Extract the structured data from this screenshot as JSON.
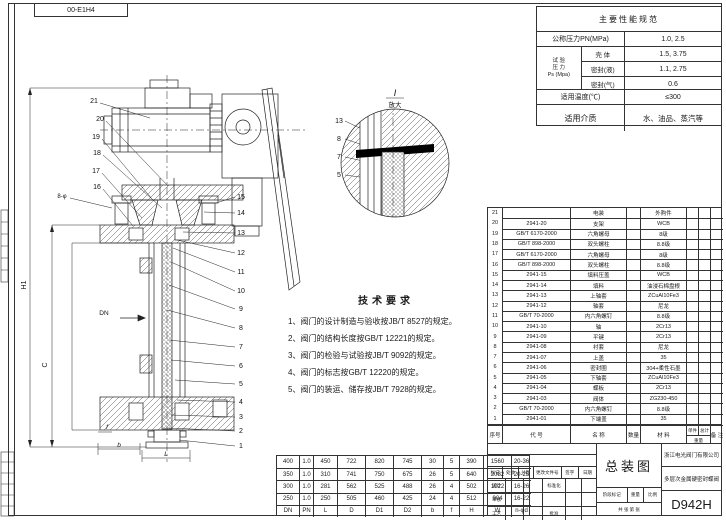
{
  "drawing_code": "00-E1H4",
  "spec_table": {
    "title": "主要性能规范",
    "pn_label": "公称压力PN(MPa)",
    "pn_value": "1.0, 2.5",
    "test_group": [
      "试 验",
      "压 力",
      "Ps (Mpa)"
    ],
    "test_rows": [
      {
        "label": "壳 体",
        "value": "1.5, 3.75"
      },
      {
        "label": "密封(液)",
        "value": "1.1, 2.75"
      },
      {
        "label": "密封(气)",
        "value": "0.6"
      }
    ],
    "temp_label": "适用温度(℃)",
    "temp_value": "≤300",
    "medium_label": "适用介质",
    "medium_value": "水、油品、蒸汽等"
  },
  "tech_requirements": {
    "title": "技术要求",
    "items": [
      "1、阀门的设计制造与验收按JB/T 8527的规定。",
      "2、阀门的结构长度按GB/T 12221的规定。",
      "3、阀门的检验与试验按JB/T 9092的规定。",
      "4、阀门的标志按GB/T 12220的规定。",
      "5、阀门的装运、储存按JB/T 7928的规定。"
    ]
  },
  "parts_table": {
    "headers": {
      "seq": "序号",
      "code": "代  号",
      "name": "名  称",
      "qty": "数量",
      "material": "材  料",
      "unit": "单件",
      "total": "总计",
      "weight": "重量",
      "note": "备 注"
    },
    "rows": [
      {
        "seq": "21",
        "code": "",
        "name": "电装",
        "qty": "",
        "mat": "外购件",
        "unit": "",
        "tot": "",
        "note": ""
      },
      {
        "seq": "20",
        "code": "2941-20",
        "name": "支架",
        "qty": "",
        "mat": "WCB",
        "unit": "",
        "tot": "",
        "note": ""
      },
      {
        "seq": "19",
        "code": "GB/T 6170-2000",
        "name": "六角螺母",
        "qty": "",
        "mat": "8级",
        "unit": "",
        "tot": "",
        "note": ""
      },
      {
        "seq": "18",
        "code": "GB/T 898-2000",
        "name": "双头螺柱",
        "qty": "",
        "mat": "8.8级",
        "unit": "",
        "tot": "",
        "note": ""
      },
      {
        "seq": "17",
        "code": "GB/T 6170-2000",
        "name": "六角螺母",
        "qty": "",
        "mat": "8级",
        "unit": "",
        "tot": "",
        "note": ""
      },
      {
        "seq": "16",
        "code": "GB/T 898-2000",
        "name": "双头螺柱",
        "qty": "",
        "mat": "8.8级",
        "unit": "",
        "tot": "",
        "note": ""
      },
      {
        "seq": "15",
        "code": "2941-15",
        "name": "填料压盖",
        "qty": "",
        "mat": "WCB",
        "unit": "",
        "tot": "",
        "note": ""
      },
      {
        "seq": "14",
        "code": "2941-14",
        "name": "填料",
        "qty": "",
        "mat": "油浸石棉盘根",
        "unit": "",
        "tot": "",
        "note": ""
      },
      {
        "seq": "13",
        "code": "2941-13",
        "name": "上轴套",
        "qty": "",
        "mat": "ZCuAl10Fe3",
        "unit": "",
        "tot": "",
        "note": ""
      },
      {
        "seq": "12",
        "code": "2941-12",
        "name": "轴套",
        "qty": "",
        "mat": "尼龙",
        "unit": "",
        "tot": "",
        "note": ""
      },
      {
        "seq": "11",
        "code": "GB/T 70-2000",
        "name": "内六角螺钉",
        "qty": "",
        "mat": "8.8级",
        "unit": "",
        "tot": "",
        "note": ""
      },
      {
        "seq": "10",
        "code": "2941-10",
        "name": "轴",
        "qty": "",
        "mat": "2Cr13",
        "unit": "",
        "tot": "",
        "note": ""
      },
      {
        "seq": "9",
        "code": "2941-09",
        "name": "平键",
        "qty": "",
        "mat": "2Cr13",
        "unit": "",
        "tot": "",
        "note": ""
      },
      {
        "seq": "8",
        "code": "2941-08",
        "name": "衬套",
        "qty": "",
        "mat": "尼龙",
        "unit": "",
        "tot": "",
        "note": ""
      },
      {
        "seq": "7",
        "code": "2941-07",
        "name": "上盖",
        "qty": "",
        "mat": "35",
        "unit": "",
        "tot": "",
        "note": ""
      },
      {
        "seq": "6",
        "code": "2941-06",
        "name": "密封圈",
        "qty": "",
        "mat": "304+柔性石墨",
        "unit": "",
        "tot": "",
        "note": ""
      },
      {
        "seq": "5",
        "code": "2941-05",
        "name": "下轴套",
        "qty": "",
        "mat": "ZCuAl10Fe3",
        "unit": "",
        "tot": "",
        "note": ""
      },
      {
        "seq": "4",
        "code": "2941-04",
        "name": "蝶板",
        "qty": "",
        "mat": "2Cr13",
        "unit": "",
        "tot": "",
        "note": ""
      },
      {
        "seq": "3",
        "code": "2941-03",
        "name": "阀体",
        "qty": "",
        "mat": "ZG230-450",
        "unit": "",
        "tot": "",
        "note": ""
      },
      {
        "seq": "2",
        "code": "GB/T 70-2000",
        "name": "内六角螺钉",
        "qty": "",
        "mat": "8.8级",
        "unit": "",
        "tot": "",
        "note": ""
      },
      {
        "seq": "1",
        "code": "2941-01",
        "name": "下端盖",
        "qty": "",
        "mat": "35",
        "unit": "",
        "tot": "",
        "note": ""
      }
    ]
  },
  "dim_table": {
    "headers": [
      "DN",
      "PN",
      "L",
      "D",
      "D1",
      "D2",
      "b",
      "f",
      "H",
      "W",
      "n-φd"
    ],
    "rows": [
      [
        "400",
        "1.0",
        "450",
        "722",
        "820",
        "745",
        "30",
        "5",
        "390",
        "1560",
        "20-36"
      ],
      [
        "350",
        "1.0",
        "310",
        "741",
        "750",
        "675",
        "26",
        "5",
        "640",
        "2082",
        "20-25"
      ],
      [
        "300",
        "1.0",
        "281",
        "562",
        "525",
        "488",
        "26",
        "4",
        "502",
        "1022",
        "16-26"
      ],
      [
        "250",
        "1.0",
        "250",
        "505",
        "460",
        "425",
        "24",
        "4",
        "512",
        "904",
        "16-22"
      ]
    ]
  },
  "title_block": {
    "view_title": "总装图",
    "company": "浙江电光阀门有限公司",
    "product": "多层次金属硬密封蝶阀",
    "model": "D942H",
    "rev_headers": [
      "标记",
      "处数",
      "分区",
      "更改文件号",
      "签字",
      "日期"
    ],
    "roles": [
      "设计",
      "审核",
      "工艺"
    ],
    "roles2": [
      "标准化",
      "",
      "批准"
    ],
    "stage_label": "阶段标记",
    "weight_label": "重量",
    "scale_label": "比例",
    "sheet_text": "共 张  第 张"
  },
  "drawing": {
    "balloons_left": [
      "21",
      "20",
      "19",
      "18",
      "17",
      "16"
    ],
    "balloons_right": [
      "15",
      "14",
      "13",
      "12",
      "11",
      "10",
      "9",
      "8",
      "7",
      "6",
      "5",
      "4",
      "3",
      "2",
      "1"
    ],
    "detail_balloons": [
      "13",
      "8",
      "7",
      "5"
    ],
    "holes_note": "8-φ",
    "detail_title": "I",
    "detail_subtitle": "放大",
    "dims": {
      "h1": "H1",
      "c": "C",
      "dn": "DN",
      "f": "f",
      "b": "b",
      "l": "L"
    }
  },
  "colors": {
    "line": "#222222",
    "hatch": "#555555",
    "paper": "#ffffff"
  }
}
